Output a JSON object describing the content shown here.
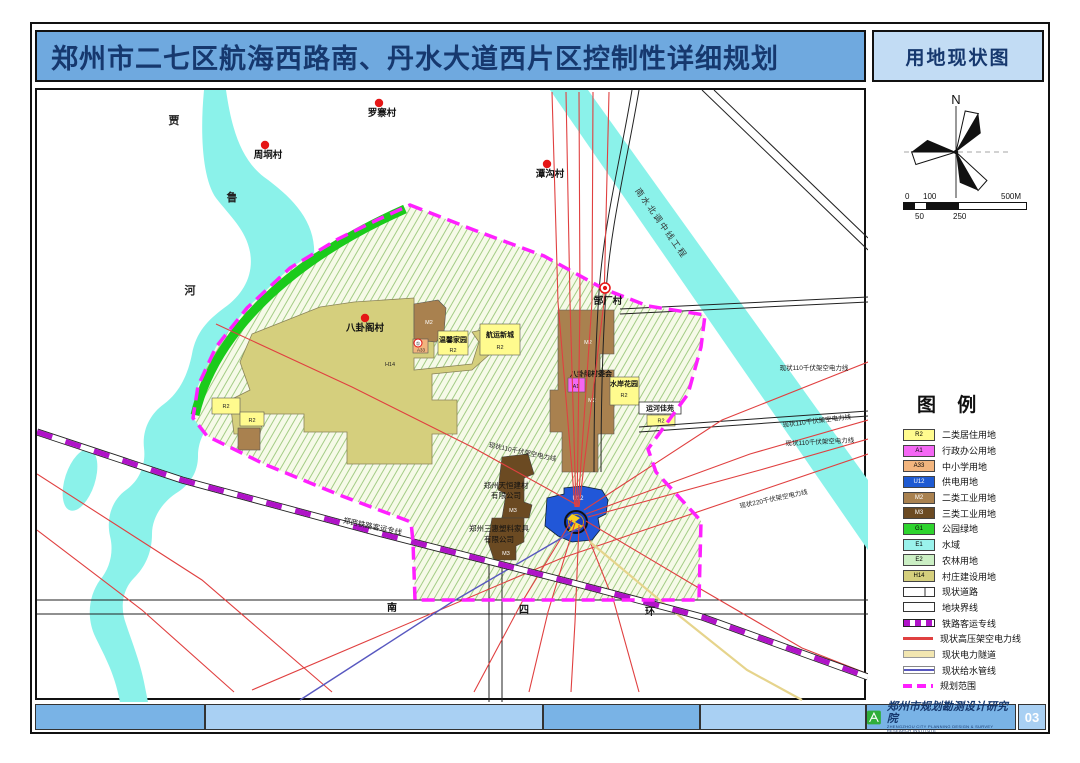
{
  "title": "郑州市二七区航海西路南、丹水大道西片区控制性详细规划",
  "panel": {
    "header": "用地现状图",
    "compass_north": "N",
    "scale": {
      "top": [
        "0",
        "100",
        "500M"
      ],
      "bottom": [
        "50",
        "250"
      ]
    }
  },
  "legend": {
    "title": "图 例",
    "area_items": [
      {
        "code": "R2",
        "label": "二类居住用地",
        "color": "#FFFB8E",
        "text": "#333333"
      },
      {
        "code": "A1",
        "label": "行政办公用地",
        "color": "#F467F4",
        "text": "#333333"
      },
      {
        "code": "A33",
        "label": "中小学用地",
        "color": "#F2B57E",
        "text": "#333333"
      },
      {
        "code": "U12",
        "label": "供电用地",
        "color": "#1E5AD2",
        "text": "#ffffff"
      },
      {
        "code": "M2",
        "label": "二类工业用地",
        "color": "#A9814F",
        "text": "#ffffff"
      },
      {
        "code": "M3",
        "label": "三类工业用地",
        "color": "#6B4A22",
        "text": "#ffffff"
      },
      {
        "code": "G1",
        "label": "公园绿地",
        "color": "#2ED42E",
        "text": "#333333"
      },
      {
        "code": "E1",
        "label": "水域",
        "color": "#9AF2EC",
        "text": "#333333"
      },
      {
        "code": "E2",
        "label": "农林用地",
        "color": "#CBEFC4",
        "text": "#333333"
      },
      {
        "code": "H14",
        "label": "村庄建设用地",
        "color": "#D5CF7D",
        "text": "#333333"
      }
    ],
    "line_items": [
      {
        "label": "现状道路"
      },
      {
        "label": "地块界线"
      },
      {
        "label": "铁路客运专线"
      },
      {
        "label": "现状高压架空电力线"
      },
      {
        "label": "现状电力隧道"
      },
      {
        "label": "现状给水管线"
      },
      {
        "label": "规划范围"
      }
    ]
  },
  "map": {
    "villages": [
      {
        "name": "罗寨村"
      },
      {
        "name": "周垌村"
      },
      {
        "name": "潭沟村"
      },
      {
        "name": "郜厂村"
      },
      {
        "name": "八卦阁村"
      }
    ],
    "river_chars": [
      "贾",
      "鲁",
      "河"
    ],
    "waterway_label": "南水北调中线工程",
    "railway_label": "郑西铁路客运专线",
    "road_chars": [
      "南",
      "四",
      "环"
    ],
    "power_labels": [
      "现状110千伏架空电力线",
      "现状110千伏架空电力线",
      "现状110千伏架空电力线",
      "现状110千伏架空电力线",
      "现状220千伏架空电力线"
    ],
    "sites": {
      "wenxin": {
        "name": "温馨家园",
        "code": "R2"
      },
      "hangyun": {
        "name": "航运新城",
        "code": "R2"
      },
      "shuian": {
        "name": "水岸花园",
        "code": "R2"
      },
      "yunhe": {
        "name": "运河佳苑",
        "code": "R2"
      },
      "cunweihui": {
        "name": "八卦阁村委会",
        "code": "A1"
      },
      "tianheng": {
        "line1": "郑州天恒建材",
        "line2": "有限公司",
        "code": "M3"
      },
      "sanhui": {
        "line1": "郑州三惠塑料家具",
        "line2": "有限公司",
        "code": "M3"
      }
    },
    "codes": {
      "h14": "H14",
      "m2": "M2",
      "r2": "R2",
      "a33": "A33",
      "u12": "U12",
      "circled_one": "①"
    }
  },
  "footer": {
    "institute": "郑州市规划勘测设计研究院",
    "institute_en": "ZHENGZHOU CITY PLANNING DESIGN & SURVEY RESEARCH INSTITUTE",
    "page_number": "03"
  },
  "colors": {
    "title_bar": "#6FA9DF",
    "panel_header_bg": "#C2DCF4",
    "title_text": "#16386E",
    "power_line": "#E04040",
    "railway": "#B013C8",
    "boundary": "#FF20FF",
    "water_pipe": "#5858C0",
    "power_tunnel": "#E6D48C",
    "footer_bar": "#79B3E6",
    "footer_bar_alt": "#A9D0F3"
  }
}
